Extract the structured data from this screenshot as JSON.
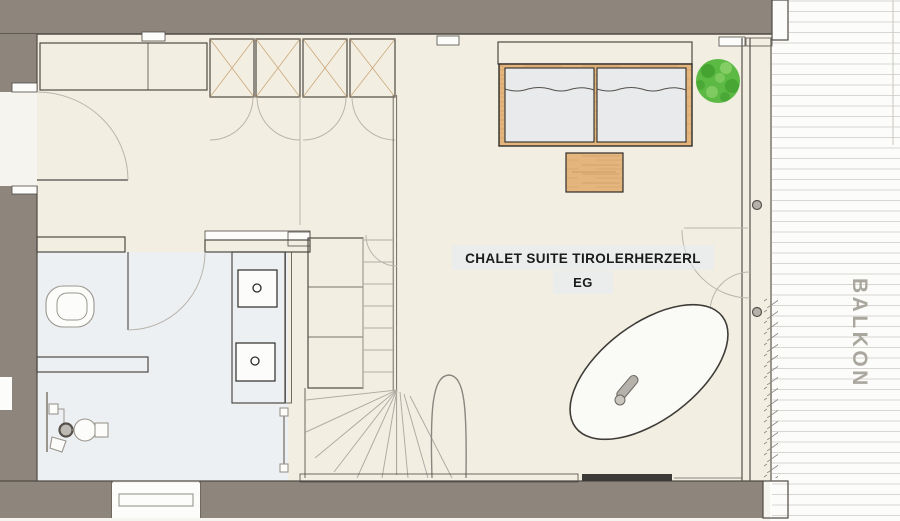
{
  "title": {
    "line1": "CHALET SUITE TIROLERHERZERL",
    "line2": "EG"
  },
  "balcony": {
    "label": "BALKON"
  },
  "rooms": {
    "main_room": "living-bedroom",
    "bathroom": "bathroom",
    "entry": "entry-hall",
    "stairs": "staircase",
    "balcony": "balcony"
  },
  "colors": {
    "wall": "#8e867c",
    "outline": "#4f4a44",
    "wood": "#e4b67e",
    "grain": "#bf8f58",
    "floor": "#f2efe2",
    "bathfloor": "#edf0f3",
    "mattress": "#e8eaec",
    "deck": "#d9d6d1",
    "arc": "#b9b5ad",
    "plant": "#5cb944",
    "plantdark": "#3e9e2d",
    "plantlight": "#8fd36e",
    "label": "#aaa79f",
    "title": "#1b1b1b",
    "fixture": "#9a968e",
    "darkbar": "#3c3a36",
    "highlight": "#e4ebf2",
    "white": "#fcfcfa"
  }
}
